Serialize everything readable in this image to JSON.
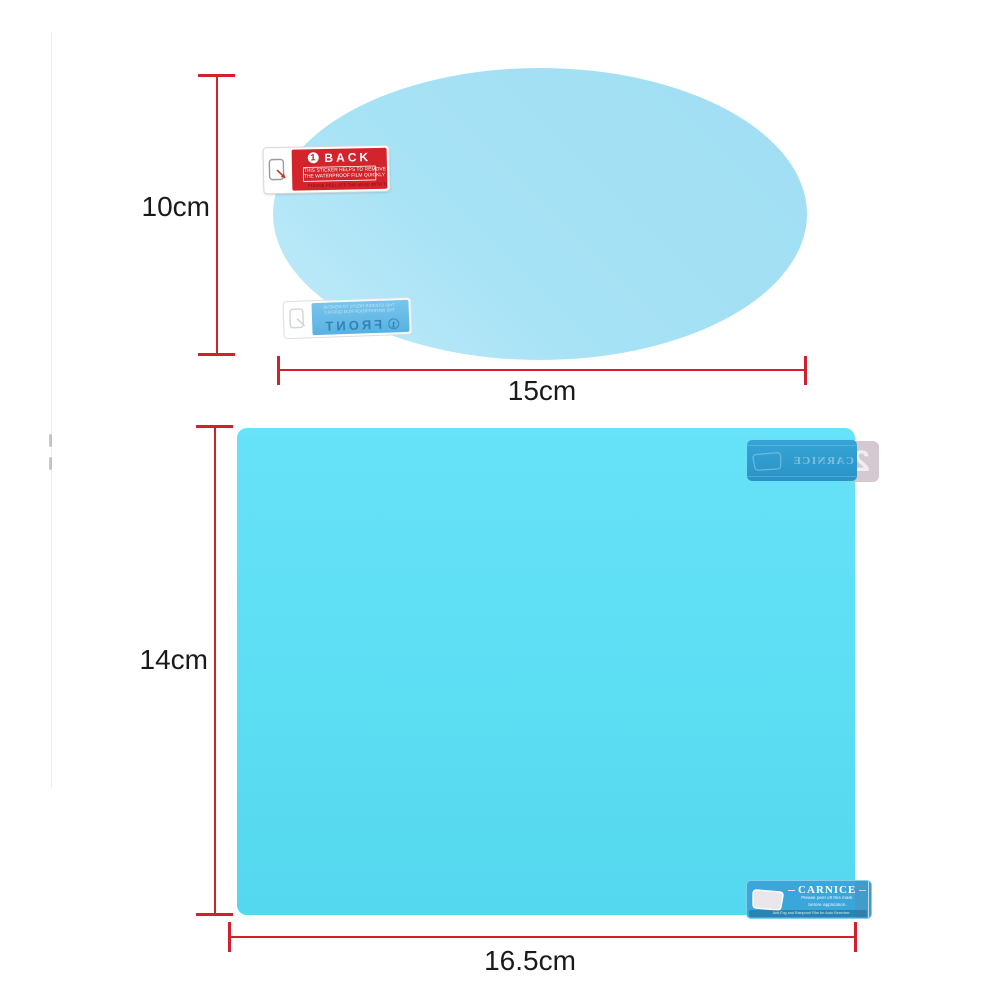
{
  "colors": {
    "accent_red": "#d2202e",
    "oval_film": "#a7e2f5",
    "rect_film": "#5cdef3",
    "back_sticker_red": "#d4242b",
    "carnice_blue": "#3ba6d9"
  },
  "dimensions": {
    "oval_height": "10cm",
    "oval_width": "15cm",
    "rect_height": "14cm",
    "rect_width": "16.5cm"
  },
  "back_sticker": {
    "number": "1",
    "title": "BACK",
    "line1": "THIS STICKER HELPS TO REMOVE",
    "line2": "THE WATERPROOF FILM QUICKLY",
    "line3": "PLEASE PEEL OFF THE MASK WITH THIS STICKER"
  },
  "front_sticker": {
    "number": "1",
    "title": "FRONT",
    "line1": "THIS STICKER HELPS TO REMOVE",
    "line2": "THE WATERPROOF FILM QUICKLY"
  },
  "sticker2": {
    "brand": "CARNICE",
    "number": "2"
  },
  "carnice": {
    "brand": "CARNICE",
    "line1": "Please peel off this mark",
    "line2": "before application.",
    "footer": "Anti-Fog and Rainproof Film for Auto Rearview",
    "number": "1"
  }
}
